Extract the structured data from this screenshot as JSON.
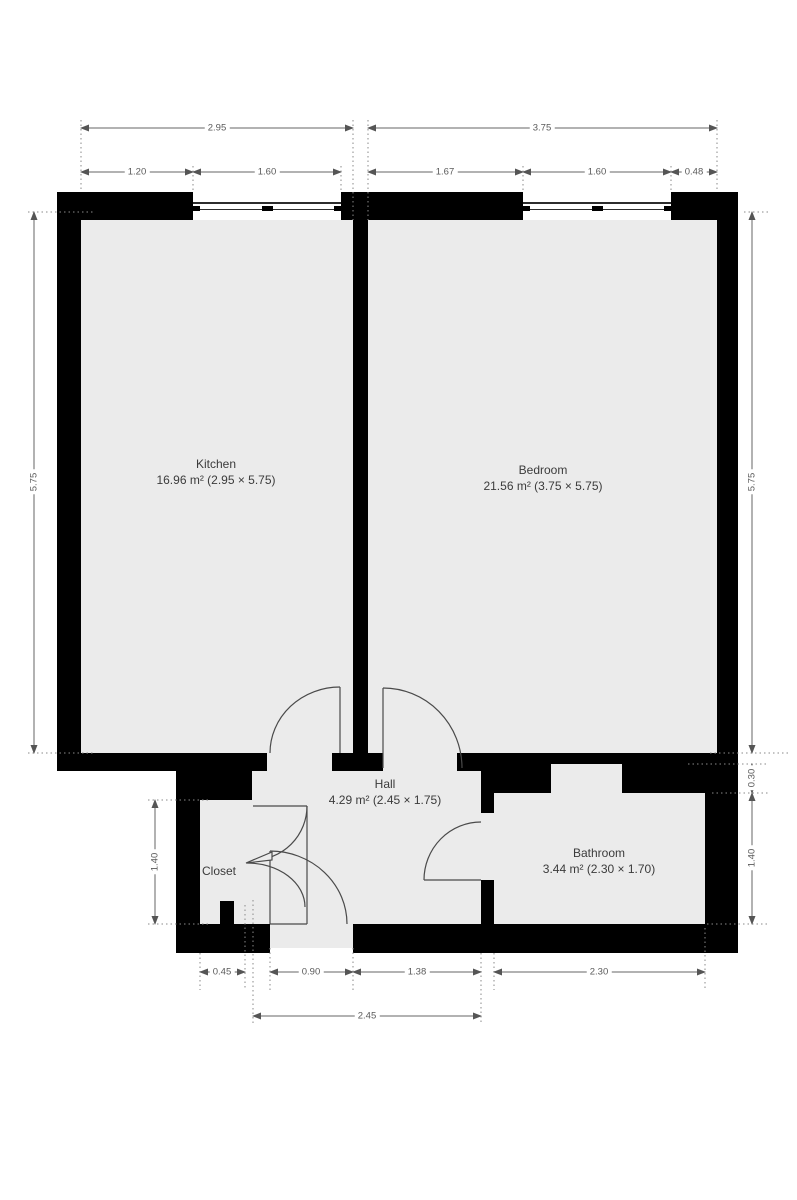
{
  "plan_title": "apartment-floor-plan",
  "rooms": {
    "kitchen": {
      "name": "Kitchen",
      "area": "16.96 m² (2.95 × 5.75)"
    },
    "bedroom": {
      "name": "Bedroom",
      "area": "21.56 m² (3.75 × 5.75)"
    },
    "hall": {
      "name": "Hall",
      "area": "4.29 m² (2.45 × 1.75)"
    },
    "closet": {
      "name": "Closet",
      "area": ""
    },
    "bathroom": {
      "name": "Bathroom",
      "area": "3.44 m² (2.30 × 1.70)"
    }
  },
  "dims": {
    "kitchen_width_total": "2.95",
    "bedroom_width_total": "3.75",
    "kitchen_wall_left": "1.20",
    "kitchen_window": "1.60",
    "bedroom_wall_left": "1.67",
    "bedroom_window": "1.60",
    "bedroom_wall_right": "0.48",
    "kitchen_height": "5.75",
    "bedroom_height": "5.75",
    "bath_step": "0.30",
    "bath_height": "1.40",
    "closet_height": "1.40",
    "closet_bottom": "0.45",
    "entrance_width": "0.90",
    "hall_bottom": "1.38",
    "bathroom_width": "2.30",
    "hall_width_total": "2.45"
  },
  "colors": {
    "wall": "#000000",
    "floor": "#ebebeb",
    "dimension_line": "#666666",
    "label_text": "#3b3b3b"
  }
}
